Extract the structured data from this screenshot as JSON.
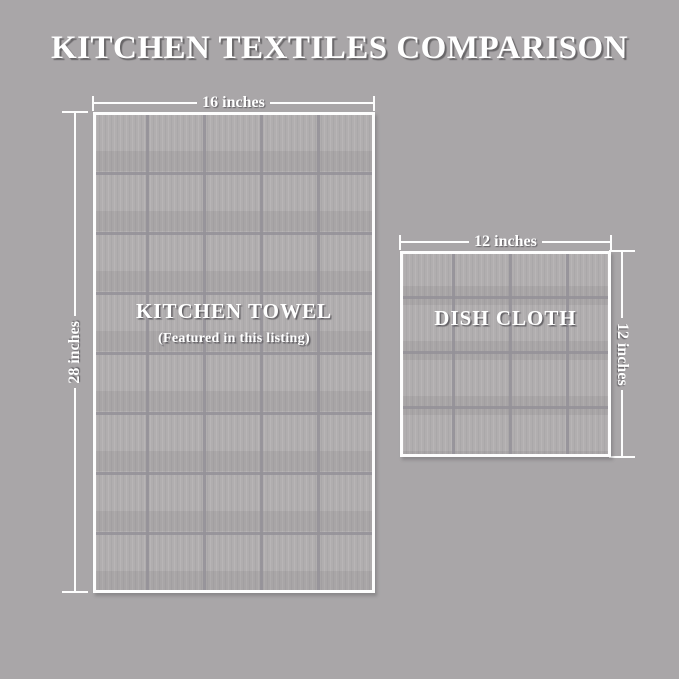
{
  "title": "KITCHEN TEXTILES COMPARISON",
  "towel": {
    "label": "KITCHEN TOWEL",
    "sublabel": "(Featured in this listing)",
    "width_label": "16 inches",
    "height_label": "28 inches"
  },
  "dish_cloth": {
    "label": "DISH CLOTH",
    "width_label": "12 inches",
    "height_label": "12 inches"
  },
  "colors": {
    "background": "#a9a6a8",
    "fabric_fill": "#b1aeaf",
    "fabric_grid": "#949198",
    "dimension_lines": "#fdfdfd",
    "text": "#ffffff",
    "text_shadow": "#5f5d60"
  }
}
